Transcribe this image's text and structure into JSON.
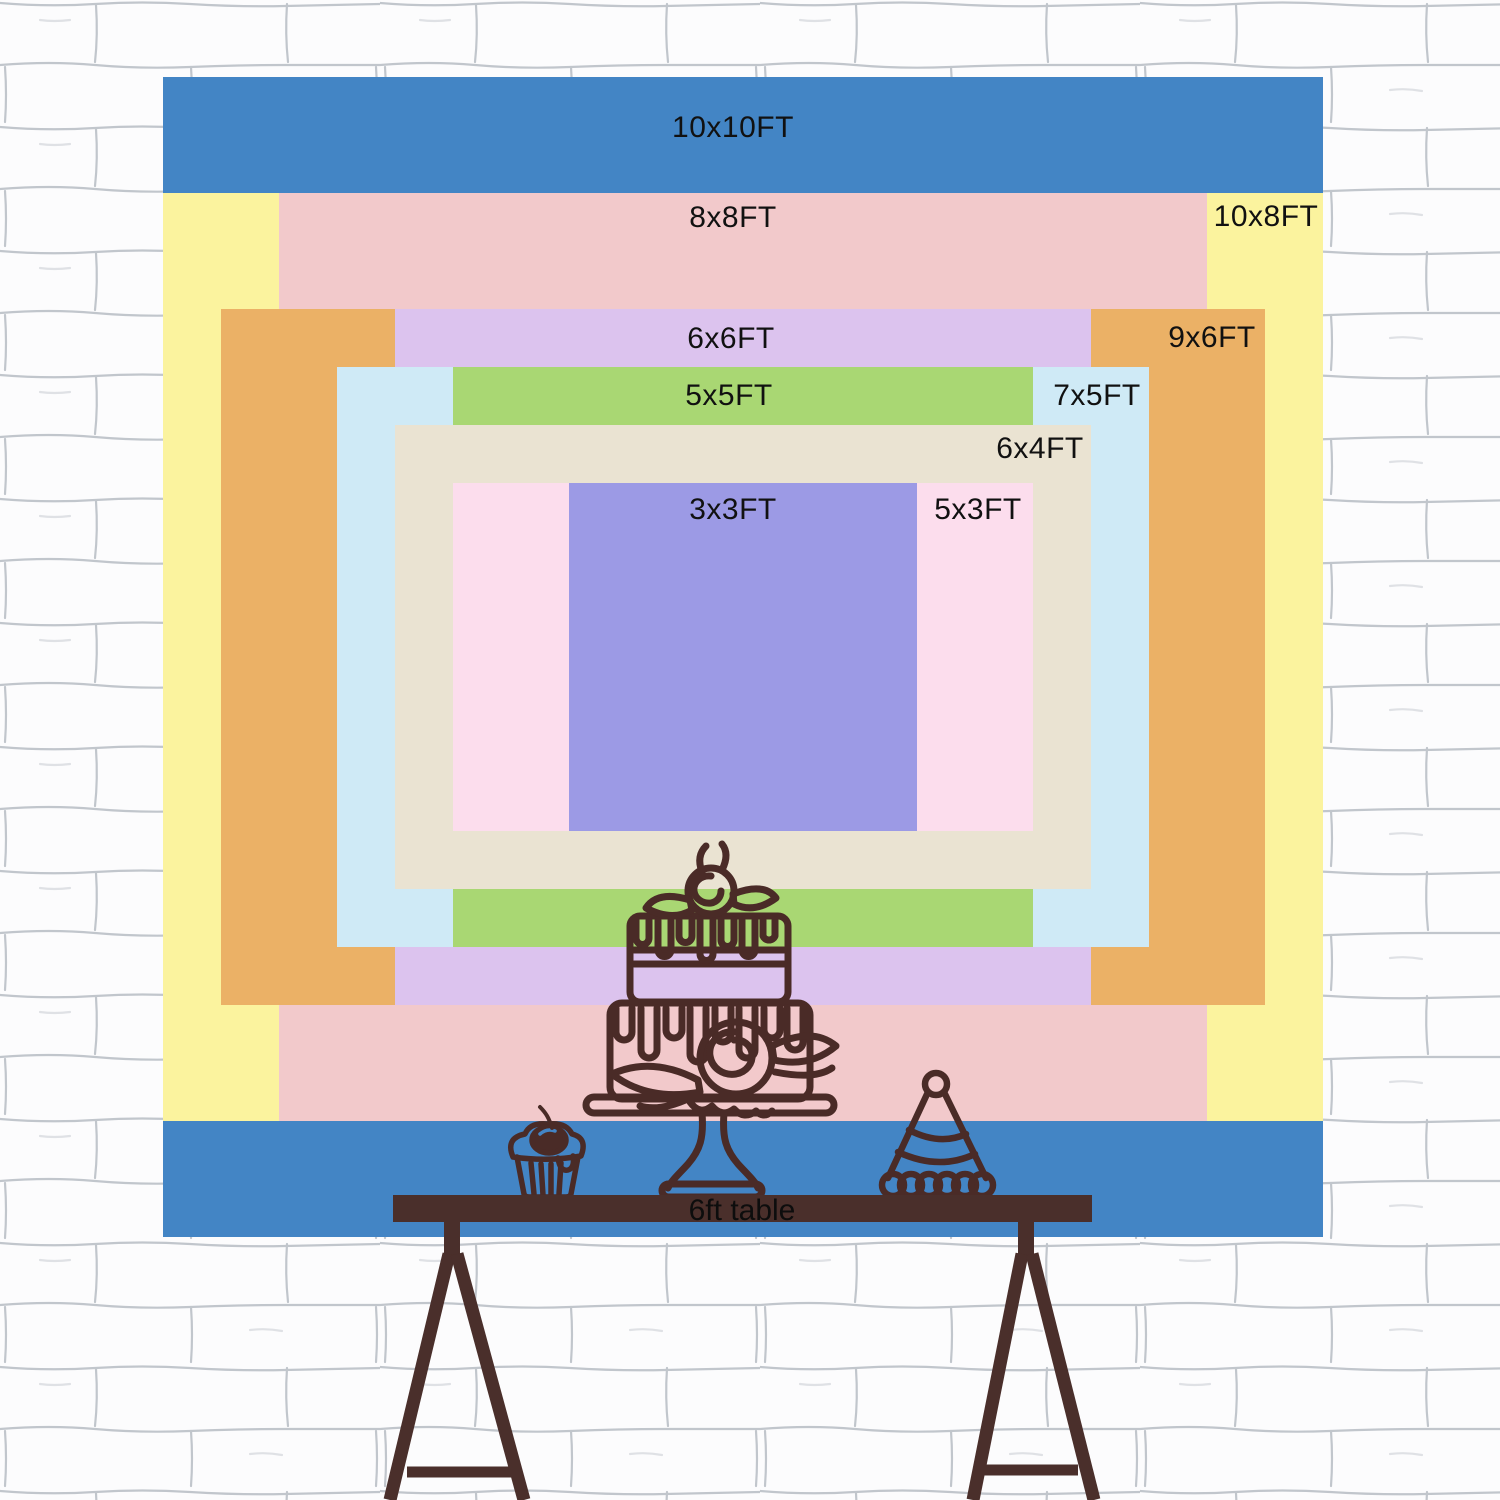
{
  "title": "Backdrop size comparison chart",
  "wall": {
    "description": "white hand-drawn brick wall",
    "mortar_color": "#99a1ac",
    "base_color": "#fcfcfd"
  },
  "backdrop": {
    "sizes": [
      {
        "id": "10x10",
        "label": "10x10FT",
        "width_ft": 10,
        "height_ft": 10,
        "color": "#4385c5"
      },
      {
        "id": "10x8",
        "label": "10x8FT",
        "width_ft": 10,
        "height_ft": 8,
        "color": "#fbf39e"
      },
      {
        "id": "8x8",
        "label": "8x8FT",
        "width_ft": 8,
        "height_ft": 8,
        "color": "#f2c9cb"
      },
      {
        "id": "9x6",
        "label": "9x6FT",
        "width_ft": 9,
        "height_ft": 6,
        "color": "#ebb166"
      },
      {
        "id": "6x6",
        "label": "6x6FT",
        "width_ft": 6,
        "height_ft": 6,
        "color": "#dcc3ee"
      },
      {
        "id": "7x5",
        "label": "7x5FT",
        "width_ft": 7,
        "height_ft": 5,
        "color": "#cfeaf6"
      },
      {
        "id": "5x5",
        "label": "5x5FT",
        "width_ft": 5,
        "height_ft": 5,
        "color": "#a9d773"
      },
      {
        "id": "6x4",
        "label": "6x4FT",
        "width_ft": 6,
        "height_ft": 4,
        "color": "#eae3d2"
      },
      {
        "id": "5x3",
        "label": "5x3FT",
        "width_ft": 5,
        "height_ft": 3,
        "color": "#fcdded"
      },
      {
        "id": "3x3",
        "label": "3x3FT",
        "width_ft": 3,
        "height_ft": 3,
        "color": "#9c9ae5"
      }
    ],
    "text_color": "#111111"
  },
  "table": {
    "label": "6ft table",
    "color": "#4a2f2b"
  },
  "ink": "#4a2b27",
  "icons": [
    {
      "name": "tiered-cake-icon"
    },
    {
      "name": "cupcake-icon"
    },
    {
      "name": "party-hat-icon"
    }
  ]
}
